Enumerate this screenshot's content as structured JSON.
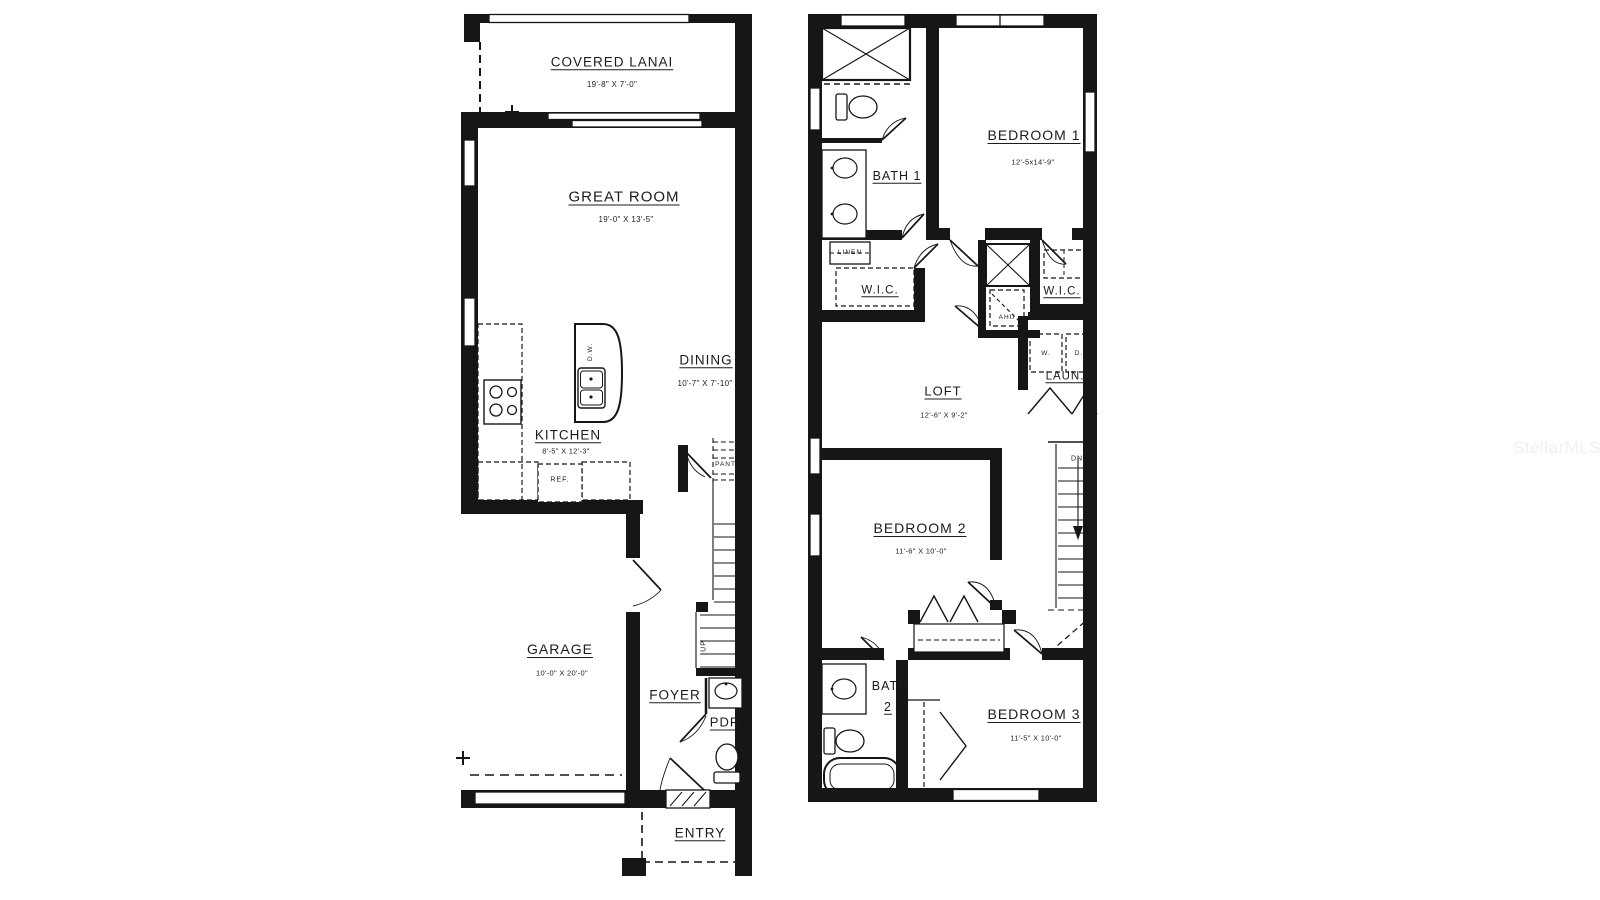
{
  "watermark": "StellarMLS",
  "colors": {
    "wall": "#161616",
    "background": "#ffffff"
  },
  "floor1": {
    "lanai_name": "COVERED LANAI",
    "lanai_dims": "19'-8\" X 7'-0\"",
    "great_room_name": "GREAT ROOM",
    "great_room_dims": "19'-0\" X 13'-5\"",
    "dining_name": "DINING",
    "dining_dims": "10'-7\" X 7'-10\"",
    "kitchen_name": "KITCHEN",
    "kitchen_dims": "8'-5\" X 12'-3\"",
    "garage_name": "GARAGE",
    "garage_dims": "10'-0\" X 20'-0\"",
    "foyer_name": "FOYER",
    "pdr_name": "PDR",
    "entry_name": "ENTRY",
    "dw_label": "D.W.",
    "ref_label": "REF.",
    "pantry_label": "PANTRY",
    "up_label": "UP"
  },
  "floor2": {
    "bedroom1_name": "BEDROOM 1",
    "bedroom1_dims": "12'-5x14'-9\"",
    "bath1_name": "BATH 1",
    "linen_label": "LINEN",
    "wic1_label": "W.I.C.",
    "wic2_label": "W.I.C.",
    "ahu_label": "AHU",
    "washer_label": "W.",
    "dryer_label": "D.",
    "laundry_name": "LAUN.",
    "loft_name": "LOFT",
    "loft_dims": "12'-6\" X 9'-2\"",
    "dn_label": "DN",
    "bedroom2_name": "BEDROOM 2",
    "bedroom2_dims": "11'-6\" X 10'-0\"",
    "bath2_line1": "BATH",
    "bath2_line2": "2",
    "bedroom3_name": "BEDROOM 3",
    "bedroom3_dims": "11'-5\" X 10'-0\""
  }
}
